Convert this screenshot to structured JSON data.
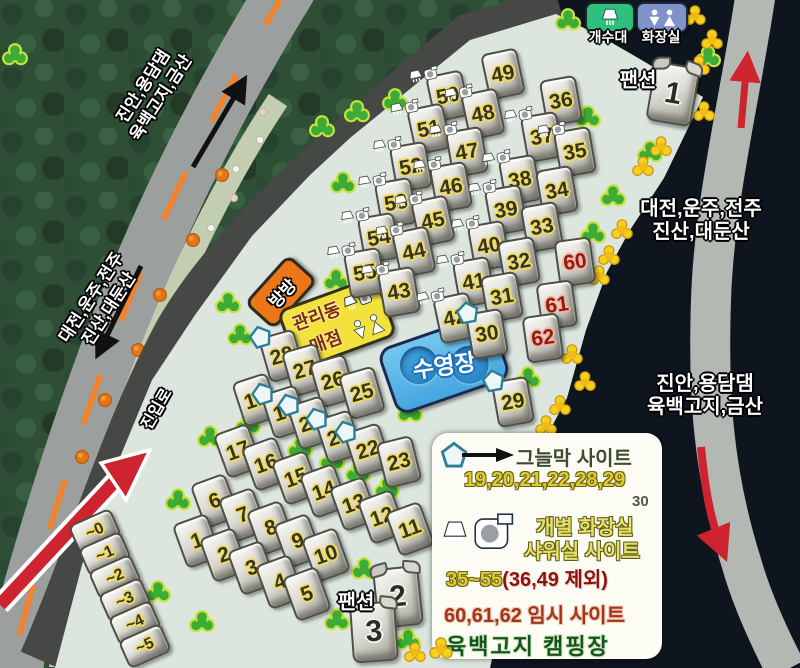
{
  "title": "육백고지 캠핑장",
  "top_facilities": {
    "sink_label": "개수대",
    "toilet_label": "화장실"
  },
  "road_labels": {
    "top_left_line1": "진안,용담댐",
    "top_left_line2": "육백고지,금산",
    "mid_left_line1": "대전,운주,전주",
    "mid_left_line2": "진산,대둔산",
    "right_upper_line1": "대전,운주,전주",
    "right_upper_line2": "진산,대둔산",
    "right_lower_line1": "진안,용담댐",
    "right_lower_line2": "육백고지,금산",
    "entrance": "진입로"
  },
  "facilities": {
    "trampoline": "방방",
    "office_line1": "관리동",
    "office_line2": "매점",
    "pool": "수영장",
    "pension_label": "팬션"
  },
  "pensions": [
    {
      "label": "1",
      "x": 673,
      "y": 94,
      "r": 10
    },
    {
      "label": "2",
      "x": 398,
      "y": 597,
      "r": -6
    },
    {
      "label": "3",
      "x": 374,
      "y": 632,
      "r": -4
    }
  ],
  "sites": [
    {
      "n": "49",
      "x": 503,
      "y": 74,
      "r": -12,
      "t": "plain"
    },
    {
      "n": "50",
      "x": 448,
      "y": 96,
      "r": -12,
      "t": "wc"
    },
    {
      "n": "48",
      "x": 483,
      "y": 114,
      "r": -12,
      "t": "wc"
    },
    {
      "n": "36",
      "x": 561,
      "y": 101,
      "r": -10,
      "t": "plain"
    },
    {
      "n": "51",
      "x": 429,
      "y": 129,
      "r": -12,
      "t": "wc"
    },
    {
      "n": "47",
      "x": 467,
      "y": 152,
      "r": -10,
      "t": "wc"
    },
    {
      "n": "37",
      "x": 542,
      "y": 137,
      "r": -10,
      "t": "wc"
    },
    {
      "n": "35",
      "x": 575,
      "y": 152,
      "r": -10,
      "t": "wc"
    },
    {
      "n": "52",
      "x": 411,
      "y": 167,
      "r": -10,
      "t": "wc"
    },
    {
      "n": "46",
      "x": 451,
      "y": 187,
      "r": -10,
      "t": "wc"
    },
    {
      "n": "38",
      "x": 520,
      "y": 180,
      "r": -10,
      "t": "wc"
    },
    {
      "n": "34",
      "x": 557,
      "y": 191,
      "r": -10,
      "t": "plain"
    },
    {
      "n": "53",
      "x": 396,
      "y": 203,
      "r": -10,
      "t": "wc"
    },
    {
      "n": "45",
      "x": 433,
      "y": 221,
      "r": -12,
      "t": "wc"
    },
    {
      "n": "39",
      "x": 506,
      "y": 210,
      "r": -10,
      "t": "wc"
    },
    {
      "n": "33",
      "x": 542,
      "y": 227,
      "r": -10,
      "t": "plain"
    },
    {
      "n": "54",
      "x": 379,
      "y": 238,
      "r": -10,
      "t": "wc"
    },
    {
      "n": "44",
      "x": 414,
      "y": 252,
      "r": -12,
      "t": "wc"
    },
    {
      "n": "40",
      "x": 489,
      "y": 246,
      "r": -10,
      "t": "wc"
    },
    {
      "n": "32",
      "x": 519,
      "y": 262,
      "r": -10,
      "t": "plain"
    },
    {
      "n": "60",
      "x": 575,
      "y": 262,
      "r": -8,
      "t": "red"
    },
    {
      "n": "55",
      "x": 365,
      "y": 273,
      "r": -10,
      "t": "wc"
    },
    {
      "n": "43",
      "x": 399,
      "y": 292,
      "r": -10,
      "t": "wc"
    },
    {
      "n": "41",
      "x": 474,
      "y": 282,
      "r": -10,
      "t": "wc"
    },
    {
      "n": "31",
      "x": 502,
      "y": 297,
      "r": -10,
      "t": "plain"
    },
    {
      "n": "61",
      "x": 557,
      "y": 305,
      "r": -8,
      "t": "red"
    },
    {
      "n": "42",
      "x": 455,
      "y": 318,
      "r": -12,
      "t": "wc"
    },
    {
      "n": "30",
      "x": 487,
      "y": 334,
      "r": -10,
      "t": "shade"
    },
    {
      "n": "62",
      "x": 543,
      "y": 338,
      "r": -8,
      "t": "red"
    },
    {
      "n": "28",
      "x": 282,
      "y": 356,
      "r": -16,
      "t": "shade"
    },
    {
      "n": "27",
      "x": 305,
      "y": 370,
      "r": -16,
      "t": "plain"
    },
    {
      "n": "26",
      "x": 333,
      "y": 381,
      "r": -16,
      "t": "plain"
    },
    {
      "n": "25",
      "x": 362,
      "y": 393,
      "r": -16,
      "t": "plain"
    },
    {
      "n": "29",
      "x": 513,
      "y": 402,
      "r": -10,
      "t": "shade"
    },
    {
      "n": "18",
      "x": 256,
      "y": 400,
      "r": -18,
      "t": "plain"
    },
    {
      "n": "19",
      "x": 285,
      "y": 412,
      "r": -18,
      "t": "shade"
    },
    {
      "n": "20",
      "x": 311,
      "y": 423,
      "r": -18,
      "t": "shade"
    },
    {
      "n": "21",
      "x": 339,
      "y": 437,
      "r": -18,
      "t": "shade"
    },
    {
      "n": "22",
      "x": 368,
      "y": 450,
      "r": -18,
      "t": "shade"
    },
    {
      "n": "23",
      "x": 399,
      "y": 462,
      "r": -14,
      "t": "plain"
    },
    {
      "n": "17",
      "x": 238,
      "y": 451,
      "r": -20,
      "t": "plain"
    },
    {
      "n": "16",
      "x": 266,
      "y": 464,
      "r": -20,
      "t": "plain"
    },
    {
      "n": "15",
      "x": 296,
      "y": 478,
      "r": -20,
      "t": "plain"
    },
    {
      "n": "14",
      "x": 324,
      "y": 491,
      "r": -20,
      "t": "plain"
    },
    {
      "n": "13",
      "x": 354,
      "y": 504,
      "r": -20,
      "t": "plain"
    },
    {
      "n": "12",
      "x": 382,
      "y": 517,
      "r": -20,
      "t": "plain"
    },
    {
      "n": "11",
      "x": 410,
      "y": 529,
      "r": -20,
      "t": "plain"
    },
    {
      "n": "6",
      "x": 215,
      "y": 501,
      "r": -20,
      "t": "plain"
    },
    {
      "n": "7",
      "x": 243,
      "y": 515,
      "r": -20,
      "t": "plain"
    },
    {
      "n": "8",
      "x": 271,
      "y": 528,
      "r": -20,
      "t": "plain"
    },
    {
      "n": "9",
      "x": 298,
      "y": 541,
      "r": -20,
      "t": "plain"
    },
    {
      "n": "10",
      "x": 326,
      "y": 555,
      "r": -20,
      "t": "plain"
    },
    {
      "n": "1",
      "x": 197,
      "y": 541,
      "r": -20,
      "t": "plain"
    },
    {
      "n": "2",
      "x": 224,
      "y": 555,
      "r": -20,
      "t": "plain"
    },
    {
      "n": "3",
      "x": 252,
      "y": 568,
      "r": -20,
      "t": "plain"
    },
    {
      "n": "4",
      "x": 280,
      "y": 582,
      "r": -20,
      "t": "plain"
    },
    {
      "n": "5",
      "x": 307,
      "y": 594,
      "r": -20,
      "t": "plain"
    },
    {
      "n": "~0",
      "x": 95,
      "y": 531,
      "r": -24,
      "t": "flat"
    },
    {
      "n": "~1",
      "x": 105,
      "y": 554,
      "r": -24,
      "t": "flat"
    },
    {
      "n": "~2",
      "x": 115,
      "y": 577,
      "r": -24,
      "t": "flat"
    },
    {
      "n": "~3",
      "x": 125,
      "y": 600,
      "r": -24,
      "t": "flat"
    },
    {
      "n": "~4",
      "x": 135,
      "y": 623,
      "r": -24,
      "t": "flat"
    },
    {
      "n": "~5",
      "x": 145,
      "y": 646,
      "r": -24,
      "t": "flat"
    }
  ],
  "legend": {
    "shade_label": "그늘막 사이트",
    "shade_sites": "19,20,21,22,28,29",
    "shade_extra": "30",
    "wc_label_line1": "개별 화장실",
    "wc_label_line2": "샤워실 사이트",
    "wc_sites": "35~55",
    "wc_excluded": "(36,49 제외)",
    "temp_sites": "60,61,62 임시 사이트",
    "campground_name": "육백고지 캠핑장"
  },
  "colors": {
    "camp_area": "#dce6df",
    "main_road": "#9b9f9d",
    "center_line": "#ef8330",
    "entrance_road": "#454845",
    "right_road": "#b4b8b2",
    "site_number_outline": "#f1dc5c",
    "temp_site_number": "#8e1c10",
    "shade_pentagon_border": "#2e7f95",
    "sink_box": "#2fbf7f",
    "toilet_box": "#8093c8",
    "office_box": "#f3e23c",
    "trampoline_box": "#ed7717",
    "pool_box": "#55b4e6",
    "arrow_red": "#cd2430"
  }
}
